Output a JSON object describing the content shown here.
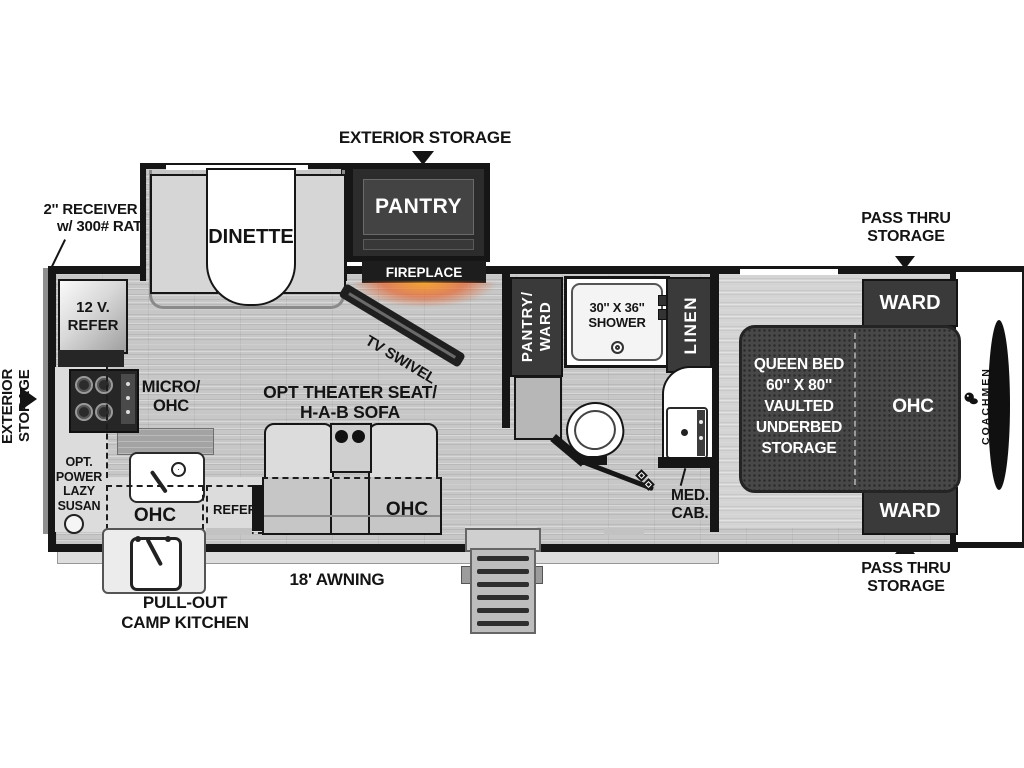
{
  "exterior": {
    "storage_top": "EXTERIOR STORAGE",
    "storage_left": "EXTERIOR STORAGE",
    "receiver_prep": [
      "2'' RECEIVER PREP",
      "w/ 300# RATING"
    ],
    "pass_thru_top": [
      "PASS THRU",
      "STORAGE"
    ],
    "pass_thru_bottom": [
      "PASS THRU",
      "STORAGE"
    ],
    "awning": "18' AWNING",
    "camp_kitchen": [
      "PULL-OUT",
      "CAMP KITCHEN"
    ]
  },
  "living": {
    "dinette": "DINETTE",
    "pantry": "PANTRY",
    "fireplace": "FIREPLACE",
    "tv": "TV SWIVEL",
    "refer_12v": [
      "12 V.",
      "REFER"
    ],
    "micro_ohc": [
      "MICRO/",
      "OHC"
    ],
    "lazy_susan": [
      "OPT.",
      "POWER",
      "LAZY",
      "SUSAN"
    ],
    "kitchen_ohc": "OHC",
    "opt_refer": "REFER",
    "theater": [
      "OPT THEATER SEAT/",
      "H-A-B SOFA"
    ],
    "sofa_ohc": "OHC"
  },
  "bath": {
    "pantry_ward": [
      "PANTRY/",
      "WARD"
    ],
    "shower": [
      "30'' X 36''",
      "SHOWER"
    ],
    "linen": "LINEN",
    "med_cab": [
      "MED.",
      "CAB."
    ]
  },
  "bedroom": {
    "ward_top": "WARD",
    "ward_bottom": "WARD",
    "bed": [
      "QUEEN BED",
      "60'' X 80''",
      "VAULTED",
      "UNDERBED",
      "STORAGE"
    ],
    "bed_ohc": "OHC",
    "brand": "COACHMEN"
  },
  "colors": {
    "wall": "#161616",
    "cabinet": "#3a3a3a",
    "floor": "#c7c7c7",
    "bed": "#484848",
    "fireplace_glow": "#f5a132",
    "white": "#ffffff"
  }
}
